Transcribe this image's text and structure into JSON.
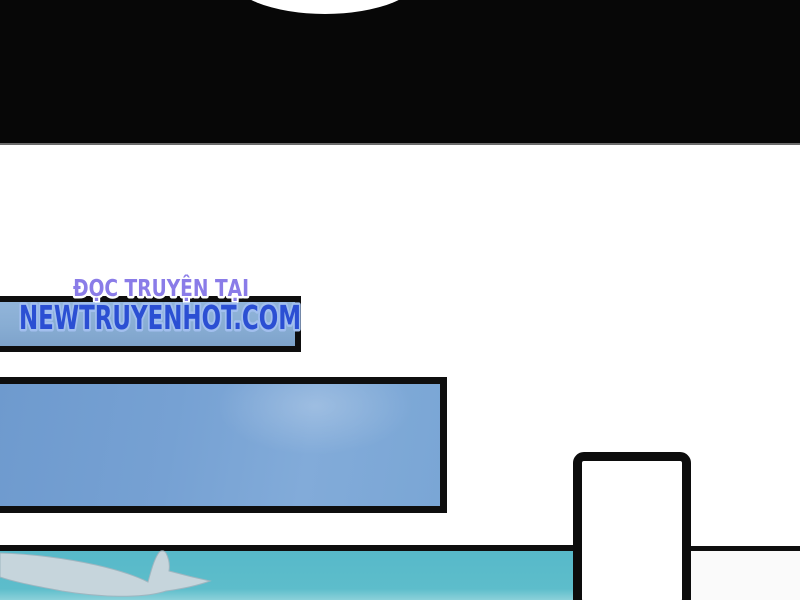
{
  "watermark": {
    "line1": "ĐỌC TRUYỆN TẠI",
    "line2": "NEWTRUYENHOT.COM"
  },
  "colors": {
    "line1_fill": "#8a7ce8",
    "line1_outline": "#ffffff",
    "line2_fill": "#2b4fd3",
    "line2_outline": "#a2bfee",
    "black_band": "#070707",
    "panel_border": "#0e0e0e",
    "panel_small_blue_fill": "#88add3",
    "panel_sky_fill": "#76a1d3",
    "panel_teal_fill": "#5bbbca",
    "wave_fill": "#c6d5dc",
    "wave_edge": "#9fb6c0",
    "bottom_right_fill": "#fafafa",
    "page_bg": "#ffffff"
  }
}
